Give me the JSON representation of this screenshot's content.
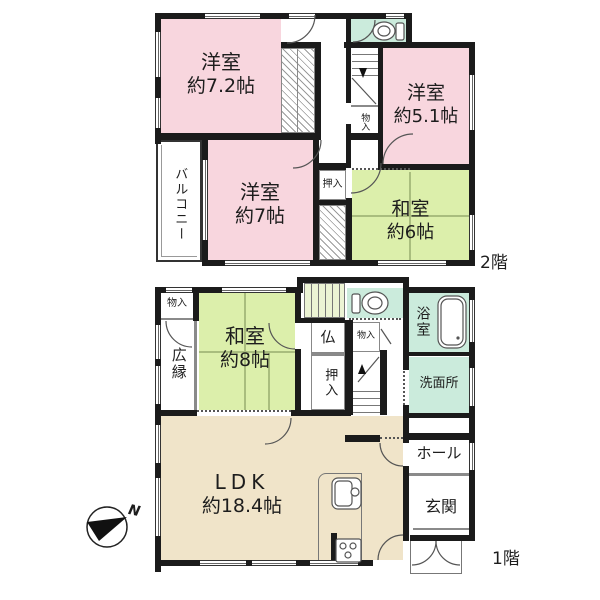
{
  "colors": {
    "wall": "#1b1b1b",
    "western_room_pink": "#f8d6de",
    "japanese_room_green": "#dcefab",
    "wet_area_mint": "#cbebdc",
    "ldk_beige": "#f0e4c9",
    "stair_tint": "#ecf4d4"
  },
  "floor2": {
    "floor_label": "2階",
    "room_yoshitsu_72": {
      "name": "洋室",
      "size": "約7.2帖"
    },
    "room_yoshitsu_51": {
      "name": "洋室",
      "size": "約5.1帖"
    },
    "room_yoshitsu_7": {
      "name": "洋室",
      "size": "約7帖"
    },
    "room_washitsu_6": {
      "name": "和室",
      "size": "約6帖"
    },
    "balcony": "バルコニー",
    "oshiire": "押入",
    "monoire": "物入"
  },
  "floor1": {
    "floor_label": "1階",
    "room_washitsu_8": {
      "name": "和室",
      "size": "約8帖"
    },
    "ldk": {
      "name": "LDK",
      "size": "約18.4帖"
    },
    "hiroen": "広縁",
    "monoire_top": "物入",
    "butsuma": "仏",
    "monoire_mid": "物入",
    "oshiire": "押入",
    "bathroom": "浴室",
    "washroom": "洗面所",
    "hall": "ホール",
    "entrance": "玄関"
  },
  "compass": {
    "north": "N"
  }
}
